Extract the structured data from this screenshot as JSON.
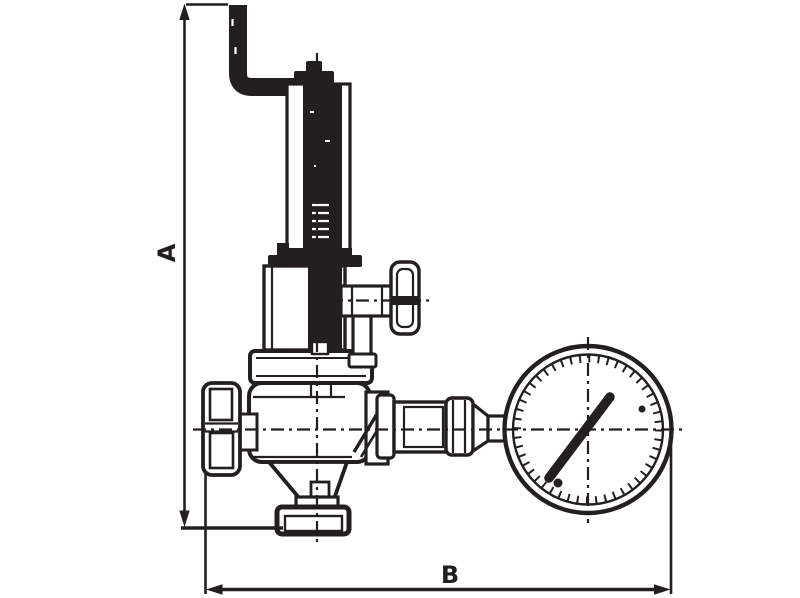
{
  "figure": {
    "kind": "technical-dimension-drawing"
  },
  "colors": {
    "line": "#231f20",
    "background": "#ffffff"
  },
  "dimensions": {
    "vertical": {
      "label": "A"
    },
    "horizontal": {
      "label": "B"
    }
  }
}
